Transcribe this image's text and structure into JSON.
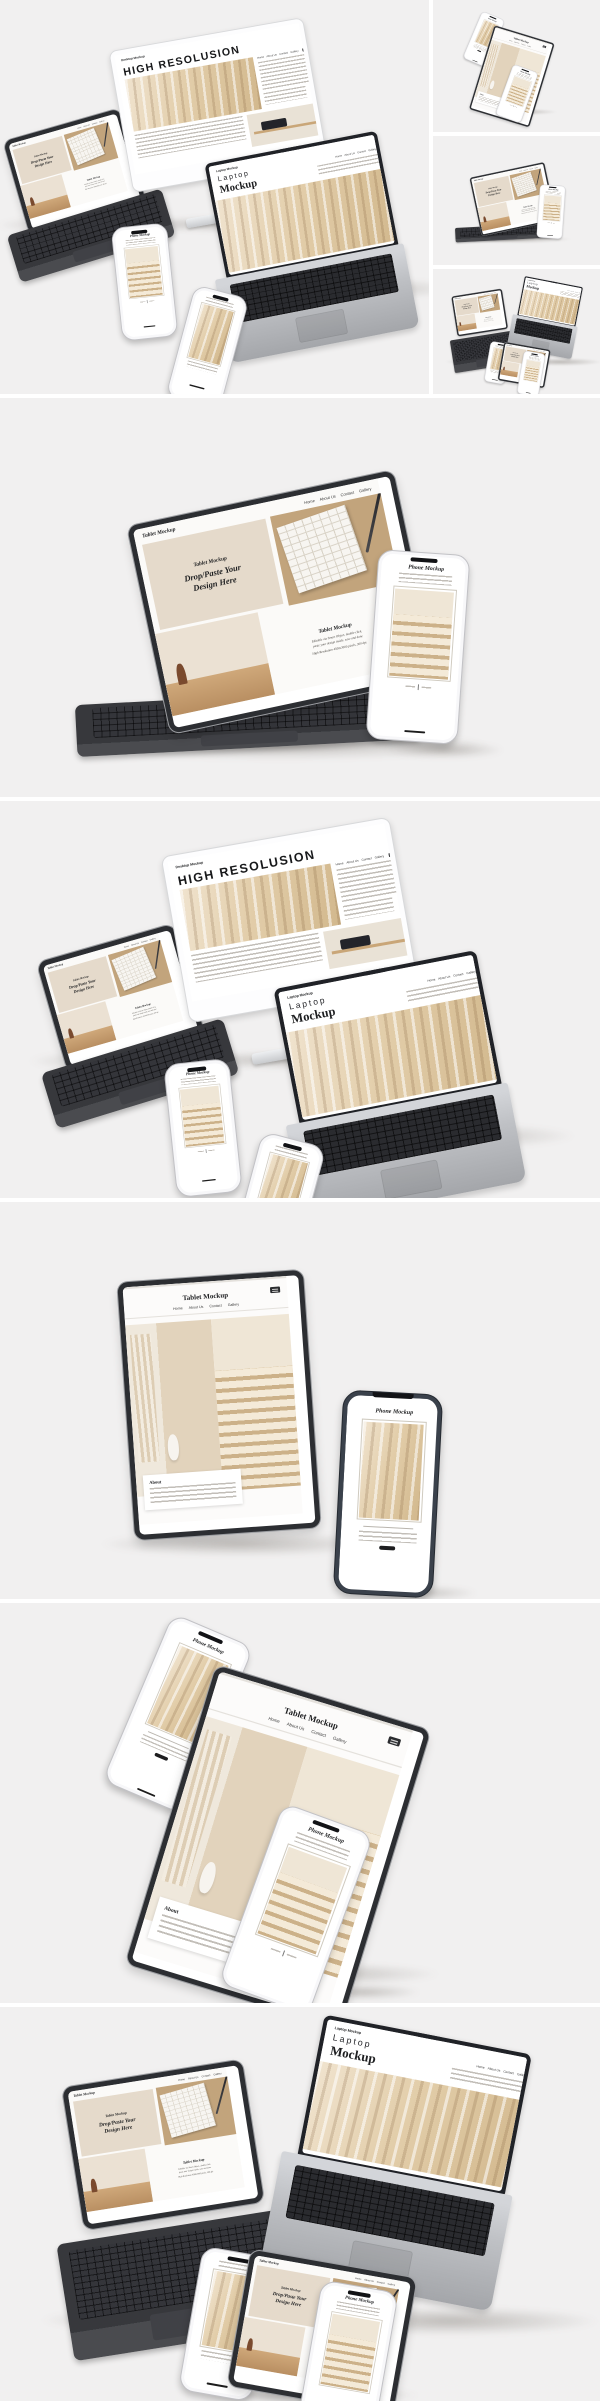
{
  "colors": {
    "panel_background": "#f1f0f0",
    "gap_color": "#ffffff",
    "hero_beige": "#e5dacb",
    "device_dark": "#2c2e32",
    "deck_silver": "#c0c2c6",
    "text_dark": "#1d1e20"
  },
  "icons": {
    "menu": "hamburger-menu",
    "dynamic_island": "black-pill",
    "home_indicator": "black-bar",
    "cta_chip": "dark-rounded-rect"
  },
  "nav": {
    "items": [
      "Home",
      "About Us",
      "Contact",
      "Gallery"
    ]
  },
  "desktop_site": {
    "brand": "Desktop Mockup",
    "title": "HIGH RESOLUSION"
  },
  "laptop_site": {
    "brand": "Laptop Mockup",
    "title_line1": "Laptop",
    "title_line2": "Mockup"
  },
  "tablet_site": {
    "brand": "Tablet Mockup",
    "hero_eyebrow": "Tablet Mockup",
    "hero_line1": "Drop/Paste Your",
    "hero_line2": "Design Here",
    "feature_title": "Tablet Mockup",
    "feature_line1": "Editable via Smart Object, double-click,",
    "feature_line2": "paste your design inside, save and done",
    "feature_line3": "High Resolution 4500x3000 pixels, 300 dpi"
  },
  "tablet_portrait_site": {
    "brand": "Tablet Mockup",
    "about_title": "About"
  },
  "phone_site": {
    "title": "Phone Mockup"
  }
}
